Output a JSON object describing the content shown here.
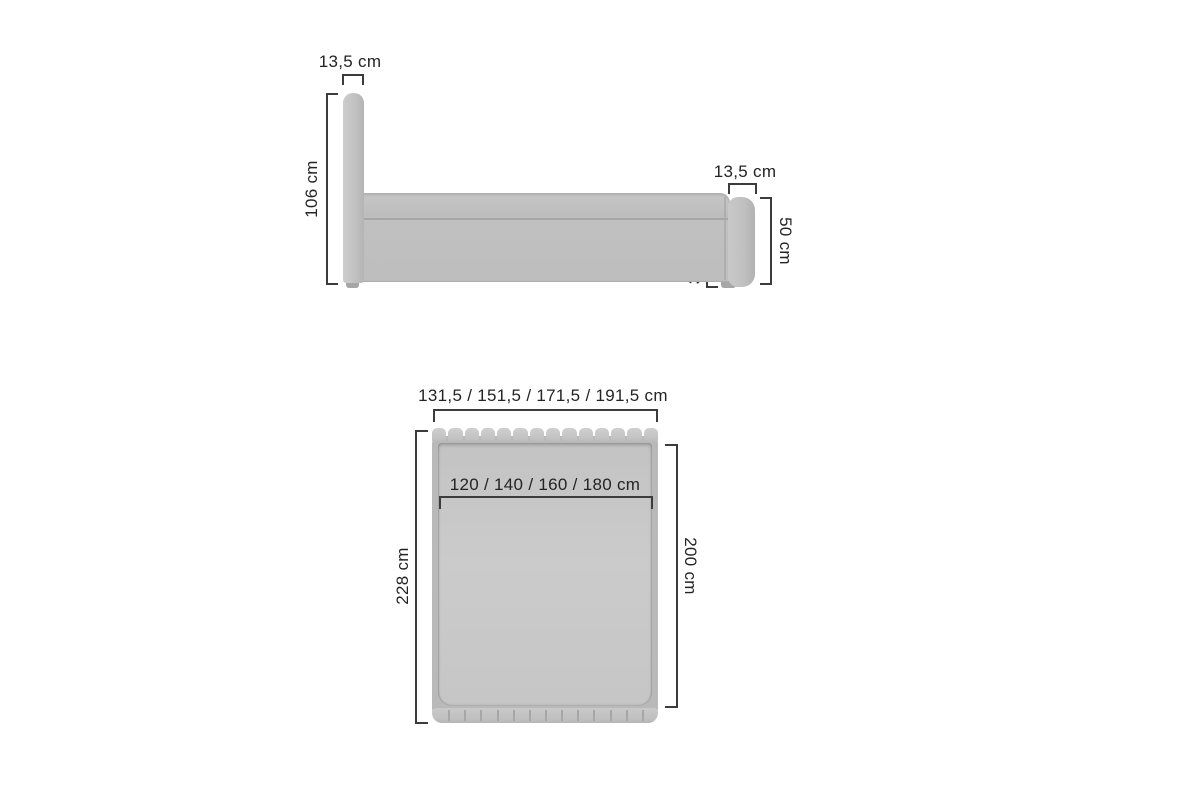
{
  "side_view": {
    "headboard_thickness_label": "13,5 cm",
    "headboard_height_label": "106 cm",
    "footboard_thickness_label": "13,5 cm",
    "footboard_height_label": "50 cm",
    "frame_height_label": "33,5 cm"
  },
  "top_view": {
    "overall_width_label": "131,5 / 151,5 / 171,5 / 191,5 cm",
    "mattress_width_label": "120 / 140 / 160 / 180 cm",
    "overall_length_label": "228 cm",
    "mattress_length_label": "200 cm",
    "headboard_segments": 14,
    "footboard_segments": 14
  },
  "colors": {
    "background": "#ffffff",
    "furniture_light": "#c9c9c9",
    "furniture_mid": "#bfbfbf",
    "furniture_dark": "#a6a6a6",
    "dimension_line": "#3c3c3c",
    "label_text": "#242424"
  }
}
